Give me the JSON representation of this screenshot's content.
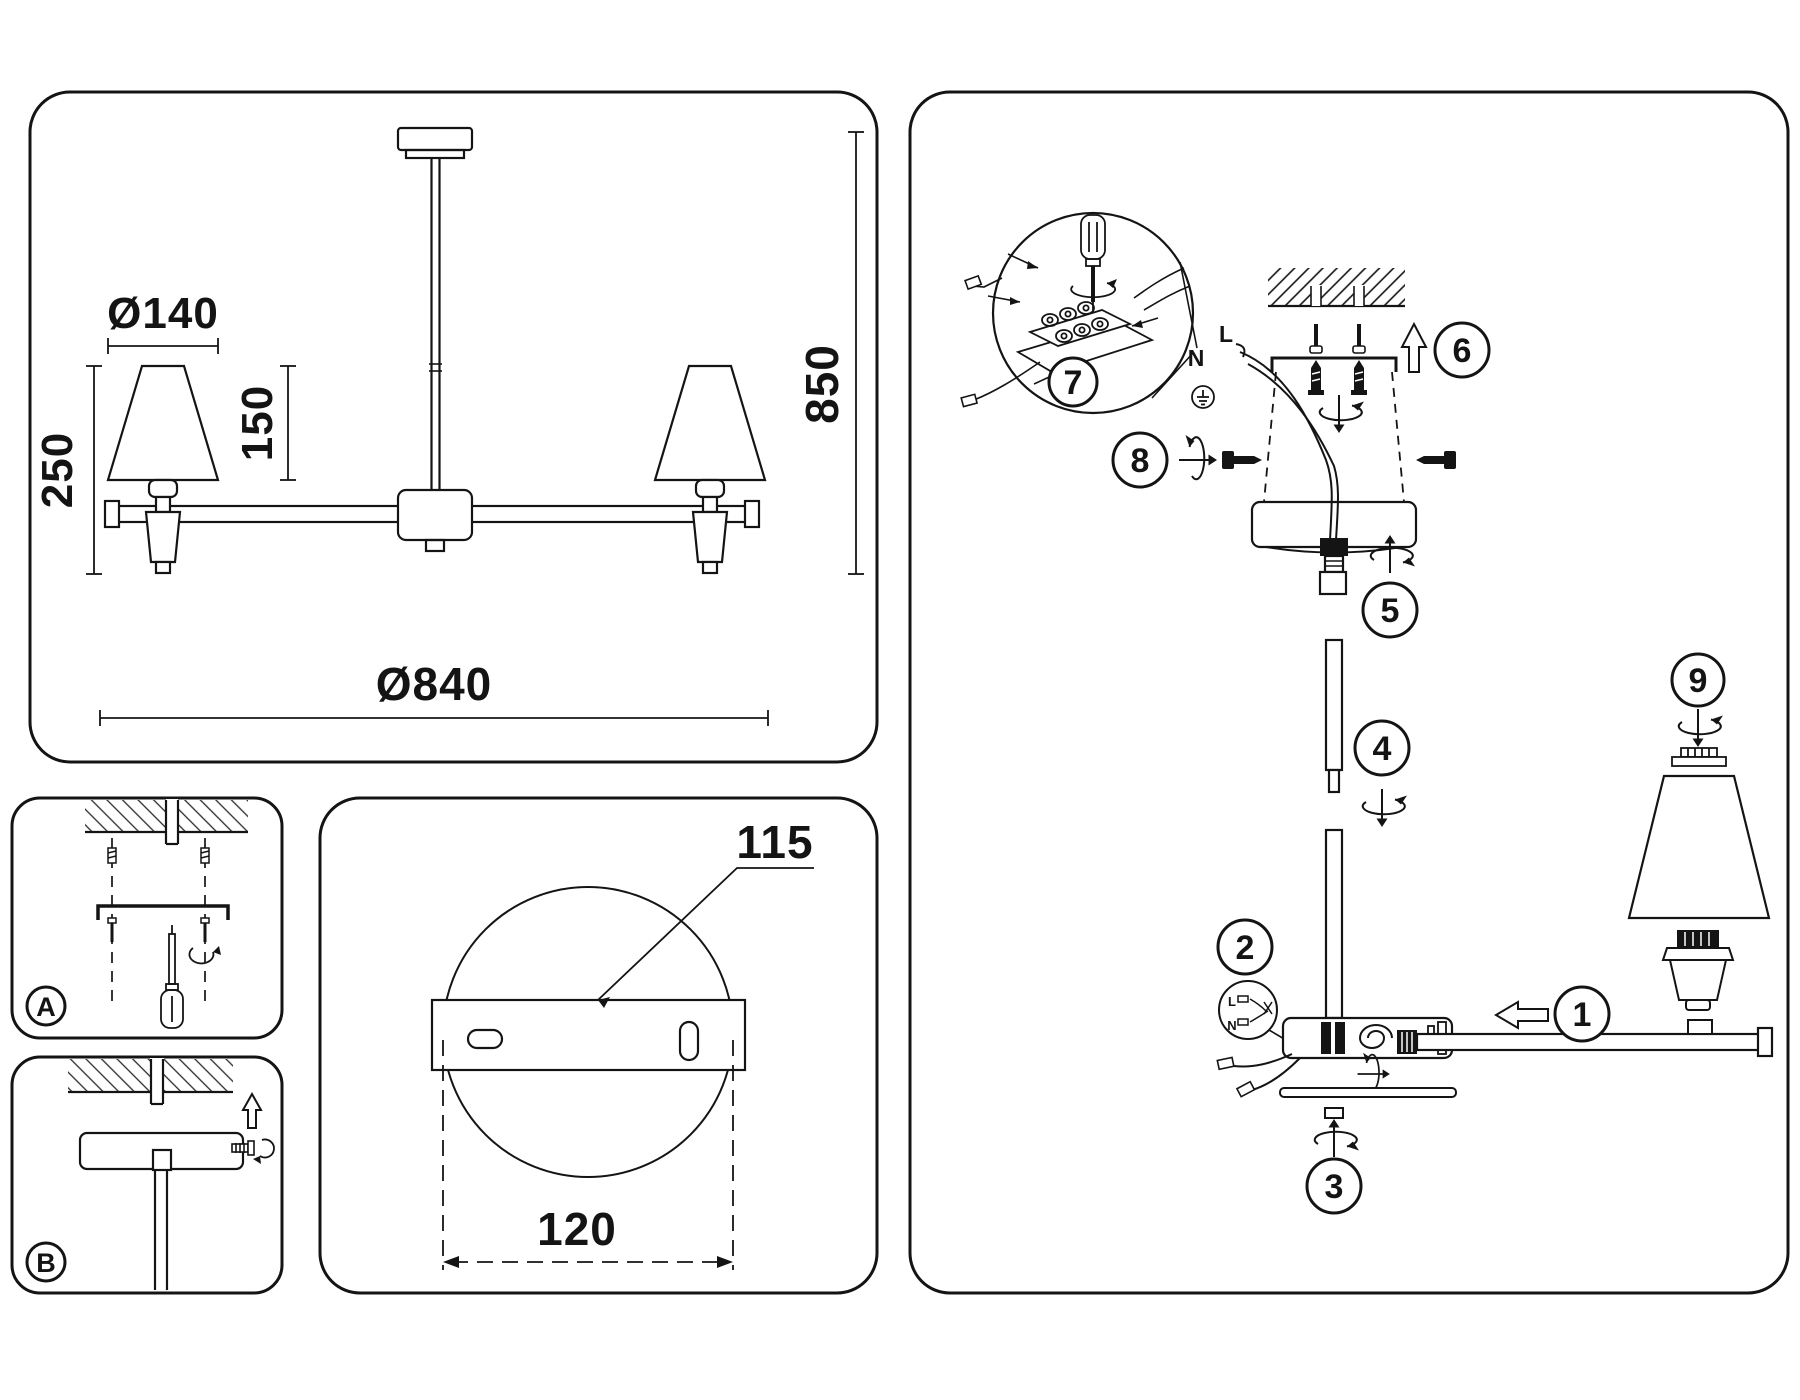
{
  "drawing": {
    "shade_diameter": "Ø140",
    "shade_height": "150",
    "lamp_total_height": "250",
    "fixture_diameter": "Ø840",
    "fixture_height": "850"
  },
  "plate": {
    "bracket_length": "115",
    "mount_span": "120"
  },
  "panels": {
    "a": "A",
    "b": "B"
  },
  "assembly": {
    "steps": [
      "1",
      "2",
      "3",
      "4",
      "5",
      "6",
      "7",
      "8",
      "9"
    ],
    "wires": {
      "neutral": "N",
      "live": "L"
    },
    "connector": {
      "live": "L",
      "neutral": "N"
    }
  }
}
